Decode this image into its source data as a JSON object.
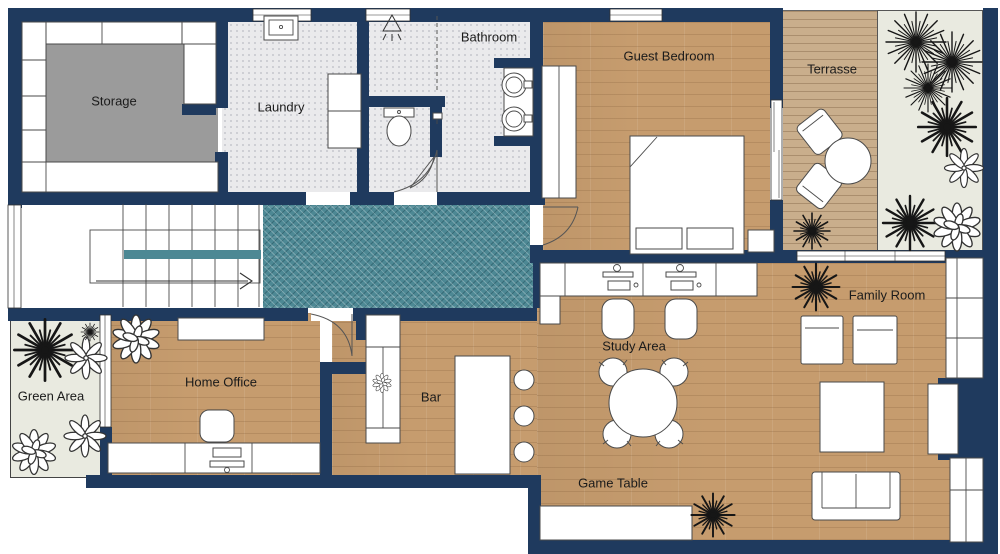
{
  "meta": {
    "type": "floor-plan"
  },
  "colors": {
    "wall": "#1f3a5e",
    "wood": "#c69c6e",
    "deck": "#c9ae8c",
    "tile": "#eaeaec",
    "hall": "#4d8894",
    "rug": "#9b9b9b",
    "garden": "#e9eae0"
  },
  "rooms": {
    "storage": {
      "label": "Storage"
    },
    "laundry": {
      "label": "Laundry"
    },
    "bathroom": {
      "label": "Bathroom"
    },
    "guest_bedroom": {
      "label": "Guest Bedroom"
    },
    "terrasse": {
      "label": "Terrasse"
    },
    "family_room": {
      "label": "Family Room"
    },
    "study_area": {
      "label": "Study Area"
    },
    "game_table": {
      "label": "Game Table"
    },
    "bar": {
      "label": "Bar"
    },
    "home_office": {
      "label": "Home Office"
    },
    "green_area": {
      "label": "Green Area"
    }
  }
}
